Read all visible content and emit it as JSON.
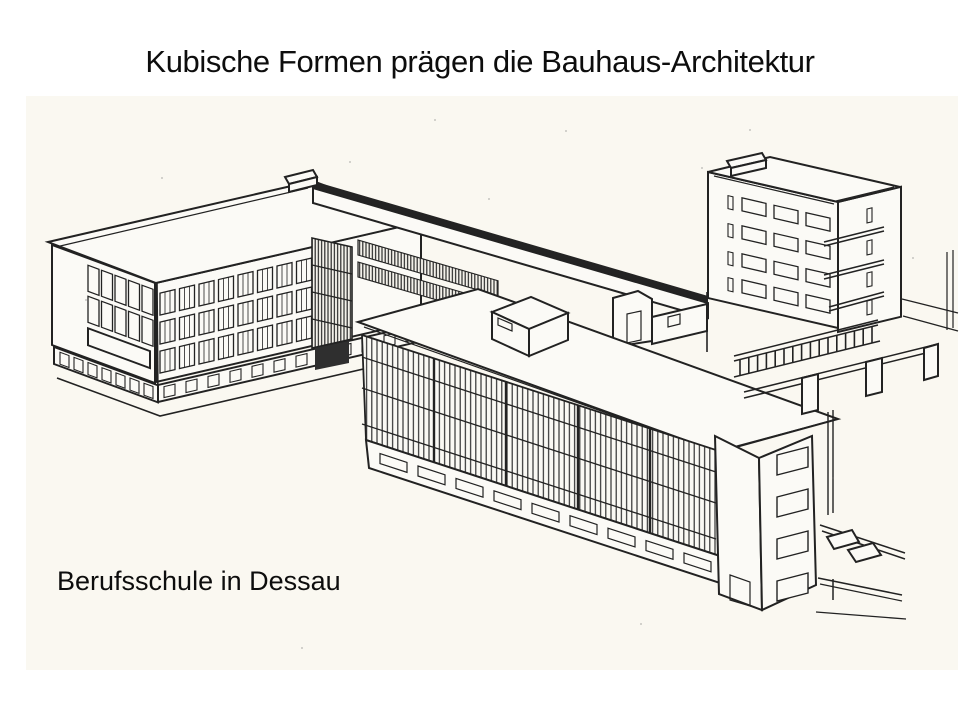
{
  "slide": {
    "title": "Kubische Formen prägen die Bauhaus-Architektur",
    "caption": "Berufsschule in Dessau",
    "figure": {
      "type": "black-and-white axonometric line drawing",
      "subject": "Bauhaus building complex in Dessau",
      "parts": [
        "school wing with ribbon windows",
        "two-storey connecting bridge",
        "workshop wing with glass curtain wall",
        "studio tower with balconies",
        "colonnade walkway",
        "rooftop housing",
        "street lines"
      ]
    },
    "colors": {
      "background": "#ffffff",
      "paper": "#faf8f1",
      "ink": "#222222",
      "text": "#0d0d0d"
    }
  }
}
